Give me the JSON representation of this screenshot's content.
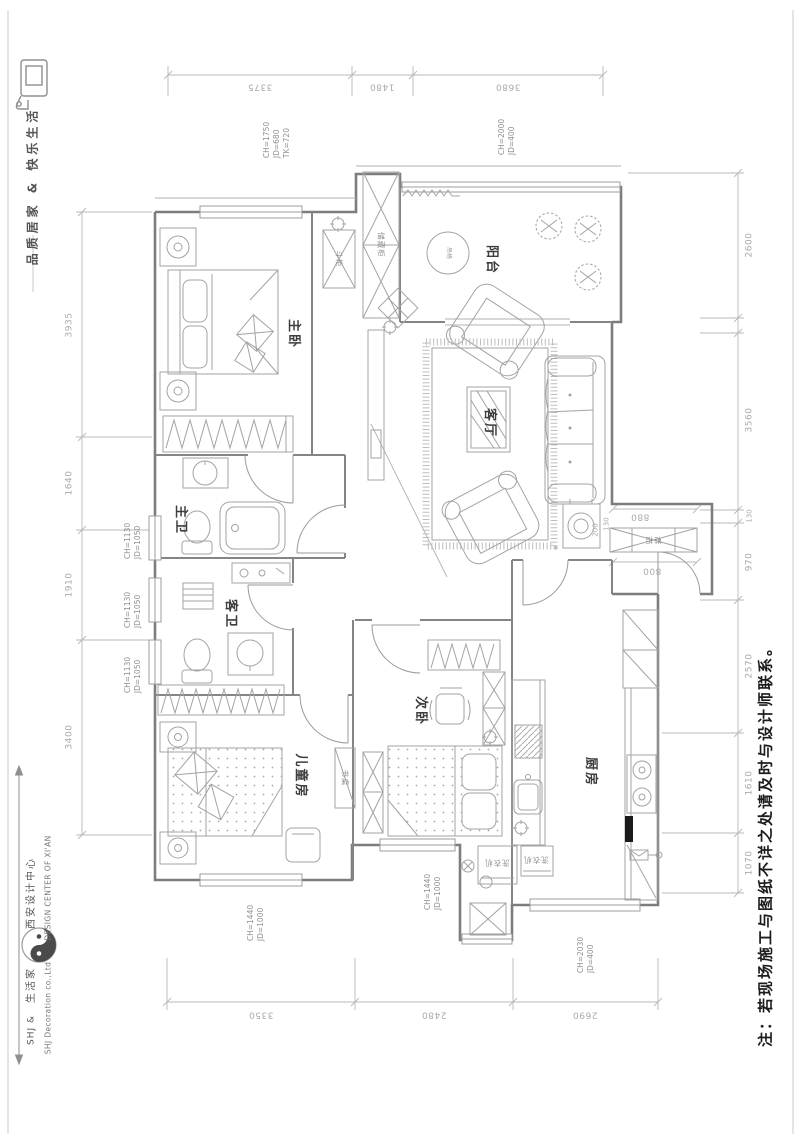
{
  "branding": {
    "tagline": "品质居家 & 快乐生活",
    "company_short": "SHJ &",
    "company_cn": "生活家",
    "company_en": "SHJ Decoration co.,Ltd",
    "center_cn": "西安设计中心",
    "center_en": "DESIGN CENTER OF XI'AN"
  },
  "note": "注：若现场施工与图纸不详之处请及时与设计师联系。",
  "rooms": {
    "master_bedroom": "主卧",
    "balcony": "阳台",
    "living_room": "客厅",
    "master_bath": "主卫",
    "guest_bath": "客卫",
    "second_bedroom": "次卧",
    "kids_room": "儿童房",
    "kitchen": "厨房"
  },
  "furniture": {
    "storage_cabinet": "储藏柜",
    "chest": "斗柜",
    "hanging_chair": "吊椅",
    "shoe_cabinet": "鞋柜",
    "desk": "书桌",
    "washer_left": "洗衣机",
    "washer_right": "洗衣机"
  },
  "dims": {
    "top": [
      "3375",
      "1480",
      "3680"
    ],
    "bottom": [
      "3350",
      "2480",
      "2690"
    ],
    "left": [
      "3935",
      "1640",
      "1910",
      "3400"
    ],
    "right": [
      "2600",
      "3560",
      "130",
      "970",
      "2570",
      "1610",
      "1070"
    ],
    "inner_880": "880",
    "inner_130": "130",
    "inner_800": "800",
    "inner_200": "200"
  },
  "callouts": {
    "c1": [
      "CH=1750",
      "JD=680",
      "TK=720"
    ],
    "c2": [
      "CH=2000",
      "JD=400"
    ],
    "c3": [
      "CH=1130",
      "JD=1050"
    ],
    "c4": [
      "CH=1130",
      "JD=1050"
    ],
    "c5": [
      "CH=1130",
      "JD=1050"
    ],
    "c6": [
      "CH=1440",
      "JD=1000"
    ],
    "c7": [
      "CH=1440",
      "JD=1000"
    ],
    "c8": [
      "CH=2030",
      "JD=400"
    ]
  }
}
